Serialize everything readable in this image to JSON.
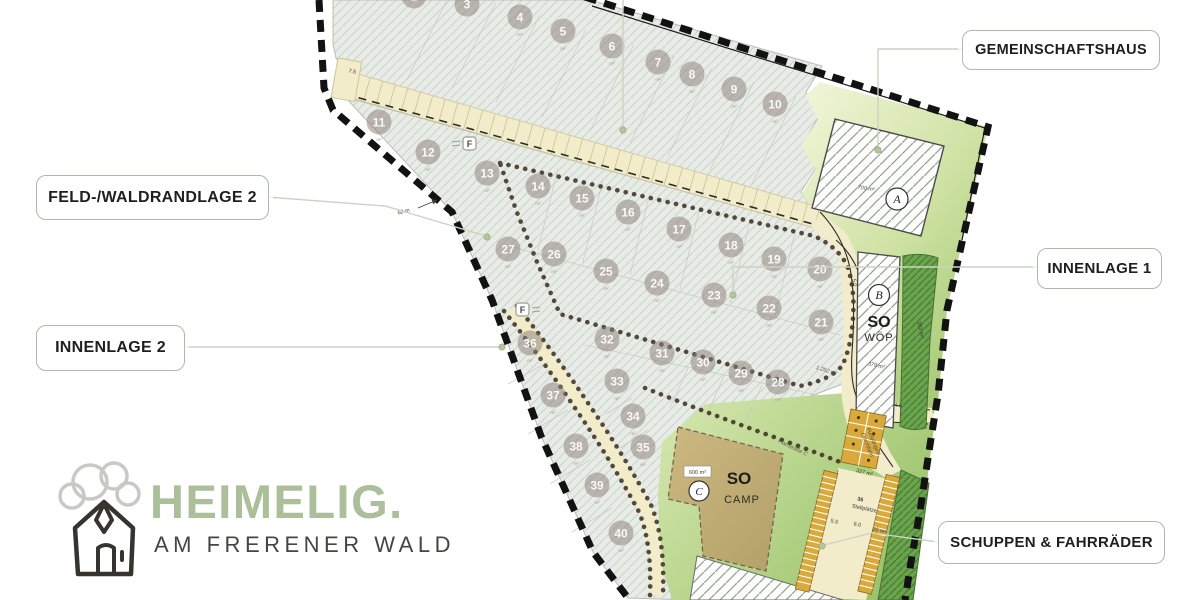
{
  "brand": {
    "name": "HEIMELIG.",
    "tagline": "AM FRERENER WALD"
  },
  "callouts": [
    {
      "label": "GEMEINSCHAFTSHAUS"
    },
    {
      "label": "FELD-/WALDRANDLAGE 2"
    },
    {
      "label": "INNENLAGE 1"
    },
    {
      "label": "INNENLAGE 2"
    },
    {
      "label": "SCHUPPEN & FAHRRÄDER"
    }
  ],
  "plan": {
    "area_suffix": "m²",
    "markers": {
      "f": "F"
    },
    "zones": {
      "building_a": {
        "badge": "A",
        "area": "700 m²"
      },
      "wop": {
        "badge": "B",
        "title": "SO",
        "subtitle": "WÖP",
        "area": "379 m²"
      },
      "camp": {
        "badge": "C",
        "title": "SO",
        "subtitle": "CAMP",
        "area": "600 m²"
      },
      "parking": {
        "count": "36",
        "label": "Stellplätze"
      },
      "street": "Planstraße C",
      "passage_line1": "Fußgänger/",
      "passage_line2": "Durchfahrt"
    },
    "dimensions": [
      {
        "text": "7.5"
      },
      {
        "text": "62 m"
      },
      {
        "text": "4.0"
      },
      {
        "text": "5.0"
      },
      {
        "text": "1.252 m²"
      },
      {
        "text": "263 m²"
      },
      {
        "text": "327 m²"
      },
      {
        "text": "5.5"
      },
      {
        "text": "6.0"
      },
      {
        "text": "20 m²"
      }
    ],
    "plots": [
      {
        "n": "2",
        "x": 414,
        "y": -4
      },
      {
        "n": "3",
        "x": 467,
        "y": 4
      },
      {
        "n": "4",
        "x": 520,
        "y": 17
      },
      {
        "n": "5",
        "x": 563,
        "y": 31
      },
      {
        "n": "6",
        "x": 612,
        "y": 46
      },
      {
        "n": "7",
        "x": 658,
        "y": 62
      },
      {
        "n": "8",
        "x": 692,
        "y": 74
      },
      {
        "n": "9",
        "x": 734,
        "y": 89
      },
      {
        "n": "10",
        "x": 775,
        "y": 104
      },
      {
        "n": "11",
        "x": 379,
        "y": 122
      },
      {
        "n": "12",
        "x": 428,
        "y": 152
      },
      {
        "n": "13",
        "x": 487,
        "y": 173
      },
      {
        "n": "14",
        "x": 538,
        "y": 186
      },
      {
        "n": "15",
        "x": 582,
        "y": 198
      },
      {
        "n": "16",
        "x": 628,
        "y": 212
      },
      {
        "n": "17",
        "x": 679,
        "y": 229
      },
      {
        "n": "18",
        "x": 731,
        "y": 245
      },
      {
        "n": "19",
        "x": 774,
        "y": 259
      },
      {
        "n": "20",
        "x": 820,
        "y": 269
      },
      {
        "n": "21",
        "x": 821,
        "y": 322
      },
      {
        "n": "22",
        "x": 769,
        "y": 308
      },
      {
        "n": "23",
        "x": 714,
        "y": 295
      },
      {
        "n": "24",
        "x": 657,
        "y": 283
      },
      {
        "n": "25",
        "x": 606,
        "y": 271
      },
      {
        "n": "26",
        "x": 554,
        "y": 254
      },
      {
        "n": "27",
        "x": 508,
        "y": 249
      },
      {
        "n": "28",
        "x": 778,
        "y": 382
      },
      {
        "n": "29",
        "x": 741,
        "y": 373
      },
      {
        "n": "30",
        "x": 703,
        "y": 362
      },
      {
        "n": "31",
        "x": 662,
        "y": 353
      },
      {
        "n": "32",
        "x": 607,
        "y": 339
      },
      {
        "n": "33",
        "x": 617,
        "y": 381
      },
      {
        "n": "34",
        "x": 633,
        "y": 416
      },
      {
        "n": "35",
        "x": 643,
        "y": 447
      },
      {
        "n": "36",
        "x": 530,
        "y": 343
      },
      {
        "n": "37",
        "x": 553,
        "y": 395
      },
      {
        "n": "38",
        "x": 576,
        "y": 446
      },
      {
        "n": "39",
        "x": 597,
        "y": 485
      },
      {
        "n": "40",
        "x": 621,
        "y": 533
      }
    ]
  },
  "colors": {
    "accent_sage": "#abbf9b",
    "boundary": "#141414",
    "road": "#f2ecca",
    "plot_fill": "#e8ece6",
    "lawn_light": "#f3f6da",
    "lawn_dark": "#a3c873",
    "hedge": "#6aa54e",
    "parking": "#d9a93c",
    "plot_circle": "#8d817b",
    "callout_border": "#aeb9a6"
  }
}
